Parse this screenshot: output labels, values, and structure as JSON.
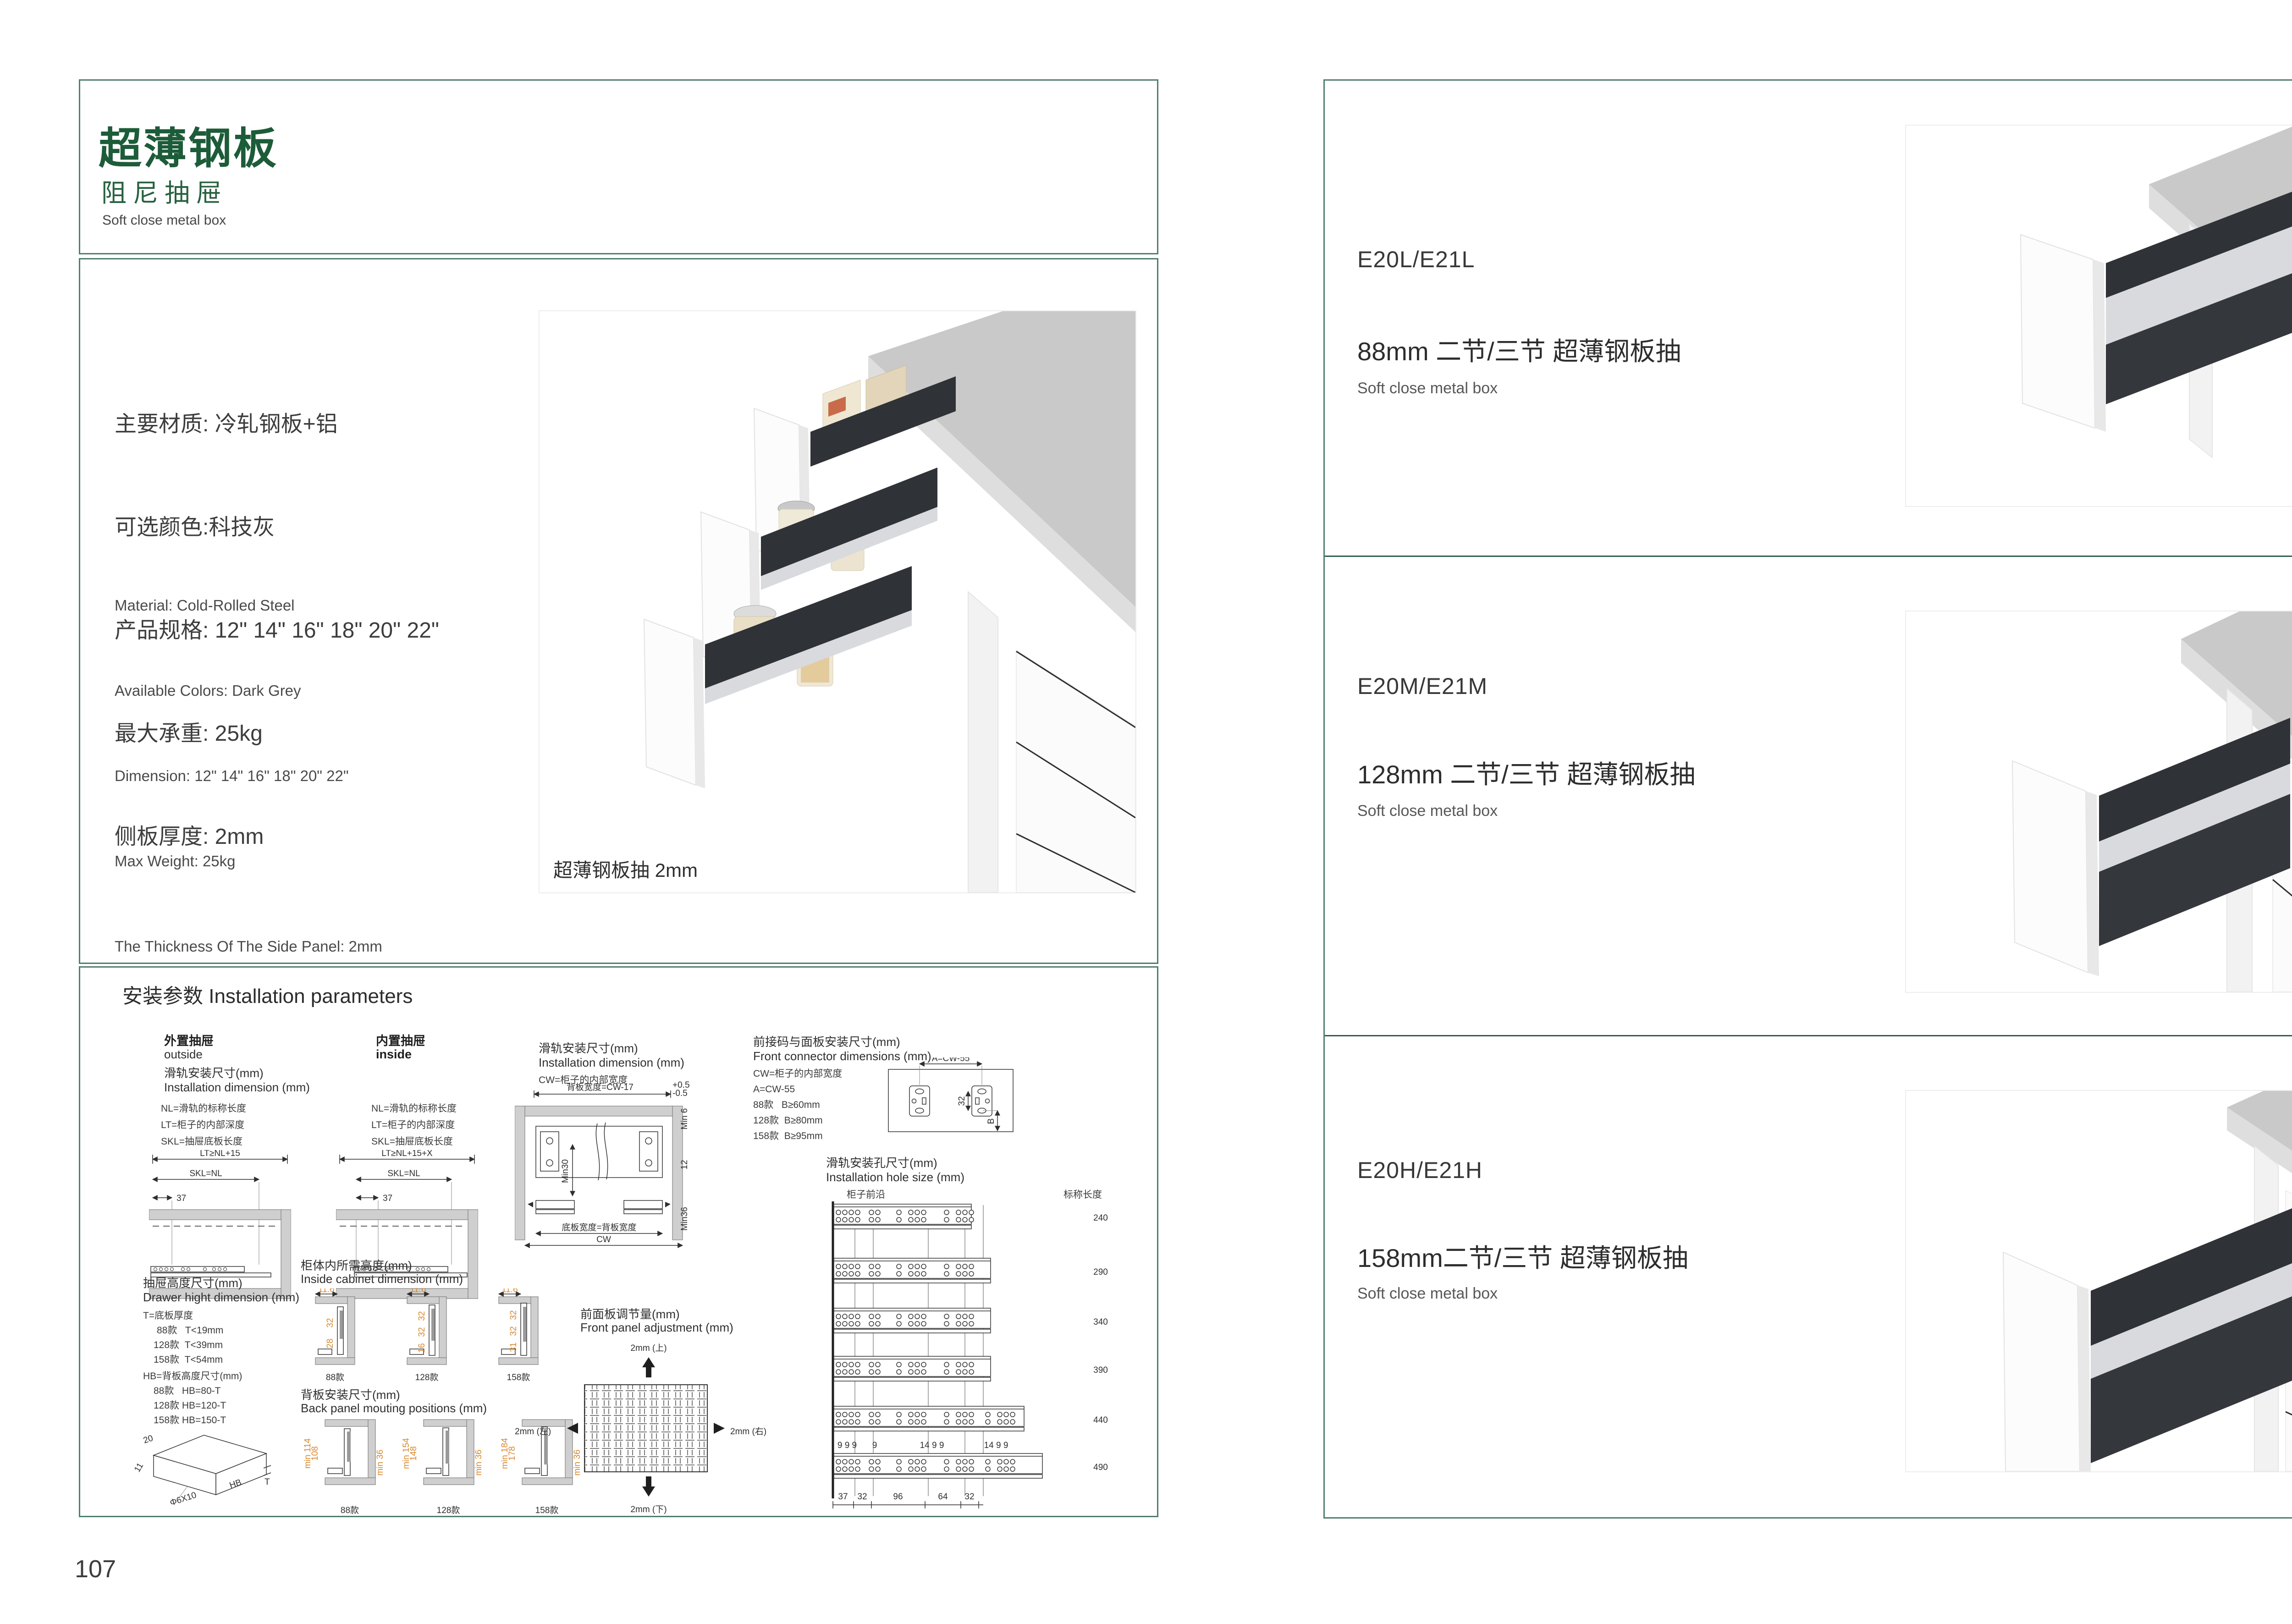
{
  "colors": {
    "border": "#517e6d",
    "divider": "#2e5f4c",
    "title_green": "#1d5c39",
    "sub_green": "#27613f",
    "dim_orange": "#d8882f",
    "text_dark": "#2f2f2f"
  },
  "page_left": {
    "page_number": "107",
    "title": {
      "main": "超薄钢板",
      "sub": "阻尼抽屉",
      "en": "Soft close metal box"
    },
    "specs_cn": [
      "主要材质: 冷轧钢板+铝",
      "可选颜色:科技灰",
      "产品规格: 12\" 14\" 16\" 18\" 20\" 22\"",
      "最大承重: 25kg",
      "侧板厚度: 2mm"
    ],
    "specs_en": [
      "Material: Cold-Rolled Steel",
      "Available Colors: Dark Grey",
      "Dimension: 12\" 14\" 16\" 18\" 20\" 22\"",
      "Max Weight: 25kg",
      "The Thickness Of The Side Panel: 2mm"
    ],
    "photo_caption": "超薄钢板抽 2mm",
    "install": {
      "header": "安装参数 Installation parameters",
      "outside": {
        "title_cn": "外置抽屉",
        "title_en": "outside",
        "dim_cn": "滑轨安装尺寸(mm)",
        "dim_en": "Installation dimension (mm)",
        "legend": [
          "NL=滑轨的标称长度",
          "LT=柜子的内部深度",
          "SKL=抽屉底板长度"
        ],
        "dim_top": "LT≥NL+15",
        "dim_mid": "SKL=NL",
        "dim_37": "37"
      },
      "inside": {
        "title_cn": "内置抽屉",
        "title_en": "inside",
        "legend": [
          "NL=滑轨的标称长度",
          "LT=柜子的内部深度",
          "SKL=抽屉底板长度"
        ],
        "dim_top": "LT≥NL+15+X",
        "dim_mid": "SKL=NL",
        "dim_37": "37",
        "dim_x": "X"
      },
      "width": {
        "dim_cn": "滑轨安装尺寸(mm)",
        "dim_en": "Installation dimension (mm)",
        "legend": "CW=柜子的内部宽度",
        "back_width": "背板宽度=CW-17",
        "tol_up": "+0.5",
        "tol_dn": "-0.5",
        "min6": "Min 6",
        "d12": "12",
        "min36": "Min36",
        "min30": "Min30",
        "bottom1": "底板宽度=背板宽度",
        "bottom2": "CW"
      },
      "connector": {
        "title_cn": "前接码与面板安装尺寸(mm)",
        "title_en": "Front connector  dimensions (mm)",
        "legend": [
          "CW=柜子的内部宽度",
          "A=CW-55",
          "88款   B≥60mm",
          "128款  B≥80mm",
          "158款  B≥95mm"
        ],
        "dim_a": "A=CW-55",
        "dim_32": "32",
        "dim_b": "B"
      },
      "holes": {
        "title_cn": "滑轨安装孔尺寸(mm)",
        "title_en": "Installation hole size (mm)",
        "front_edge": "柜子前沿",
        "length_header": "标称长度",
        "lengths": [
          "240",
          "290",
          "340",
          "390",
          "440",
          "490"
        ],
        "top_dims": [
          "9 9 9",
          "9",
          "14 9 9",
          "14 9 9"
        ],
        "bottom_dims": [
          "37",
          "32",
          "96",
          "64",
          "32"
        ]
      },
      "height": {
        "title_cn": "抽屉高度尺寸(mm)",
        "title_en": "Drawer hight dimension (mm)",
        "t_lines": [
          "T=底板厚度",
          "88款   T<19mm",
          "128款  T<39mm",
          "158款  T<54mm"
        ],
        "hb_lines": [
          "HB=背板高度尺寸(mm)",
          "88款   HB=80-T",
          "128款 HB=120-T",
          "158款 HB=150-T"
        ],
        "sketch": {
          "d20": "20",
          "d11": "11",
          "phi": "Φ6X10",
          "hb": "HB",
          "t": "T"
        }
      },
      "cabinet_height": {
        "title_cn": "柜体内所需高度(mm)",
        "title_en": "Inside cabinet dimension (mm)",
        "models": [
          {
            "label": "88款",
            "top": "11.6",
            "dims": [
              "32",
              "28"
            ]
          },
          {
            "label": "128款",
            "top": "11.6",
            "dims": [
              "32",
              "32",
              "16"
            ]
          },
          {
            "label": "158款",
            "top": "11.6",
            "dims": [
              "32",
              "32",
              "31"
            ]
          }
        ]
      },
      "back_panel": {
        "title_cn": "背板安装尺寸(mm)",
        "title_en": "Back panel mouting positions (mm)",
        "models": [
          {
            "label": "88款",
            "left1": "min 114",
            "left2": "108",
            "right": "min 36"
          },
          {
            "label": "128款",
            "left1": "min 154",
            "left2": "148",
            "right": "min 36"
          },
          {
            "label": "158款",
            "left1": "min 184",
            "left2": "178",
            "right": "min 36"
          }
        ]
      },
      "adjust": {
        "title_cn": "前面板调节量(mm)",
        "title_en": "Front panel adjustment (mm)",
        "up": "2mm (上)",
        "down": "2mm (下)",
        "left": "2mm (左)",
        "right": "2mm (右)"
      }
    }
  },
  "page_right": {
    "page_number": "108",
    "sections": [
      {
        "code": "E20L/E21L",
        "size_line": "88mm 二节/三节 超薄钢板抽",
        "en": "Soft close metal box"
      },
      {
        "code": "E20M/E21M",
        "size_line": "128mm 二节/三节 超薄钢板抽",
        "en": "Soft close metal box"
      },
      {
        "code": "E20H/E21H",
        "size_line": "158mm二节/三节 超薄钢板抽",
        "en": "Soft close metal box"
      }
    ]
  }
}
